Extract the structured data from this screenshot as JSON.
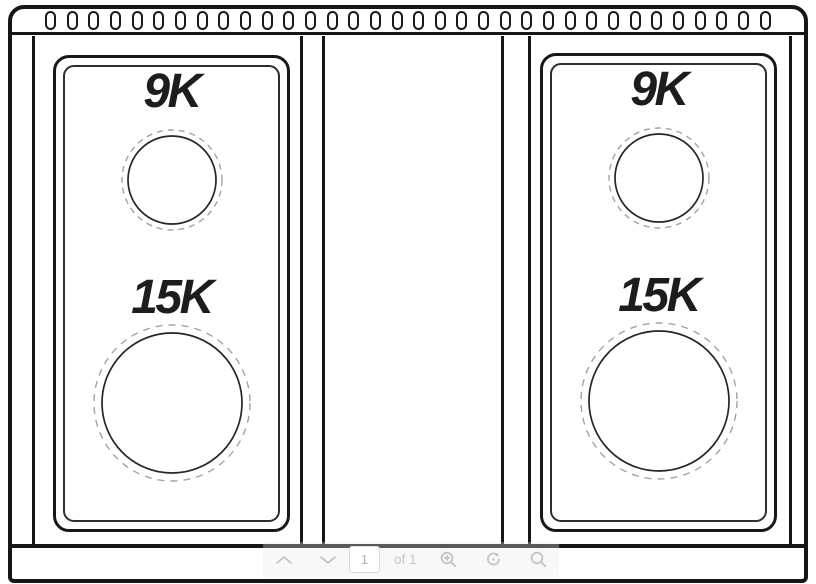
{
  "diagram": {
    "type": "rangetop-top-view-line-drawing",
    "vent_slot_count": 34,
    "line_color": "#161616",
    "dashed_circle_color": "#a3a3a3",
    "label_color": "#1d1d1d",
    "panels": [
      {
        "id": "left",
        "burners": [
          {
            "label": "9K",
            "size": "small"
          },
          {
            "label": "15K",
            "size": "large"
          }
        ]
      },
      {
        "id": "right",
        "burners": [
          {
            "label": "9K",
            "size": "small"
          },
          {
            "label": "15K",
            "size": "large"
          }
        ]
      }
    ]
  },
  "viewer_toolbar": {
    "page_input_value": "1",
    "page_count_label": "of 1",
    "icon_color": "#c1c1c1",
    "icons": {
      "previous_page": "chevron-up",
      "next_page": "chevron-down",
      "zoom_in": "magnifier-plus",
      "rotate": "circular-arrow",
      "search": "magnifier"
    }
  }
}
